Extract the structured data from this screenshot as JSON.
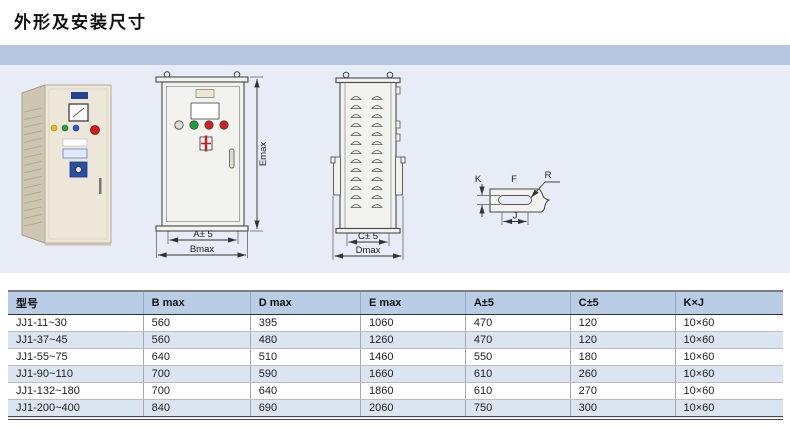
{
  "page": {
    "title": "外形及安装尺寸"
  },
  "drawings": {
    "front_view": {
      "height_label": "Emax",
      "inner_width_label": "A± 5",
      "outer_width_label": "Bmax"
    },
    "side_view": {
      "inner_depth_label": "C± 5",
      "outer_depth_label": "Dmax"
    },
    "slot_detail": {
      "plate_label": "F",
      "radius_label": "R",
      "slot_width_label": "K",
      "slot_length_label": "J"
    },
    "indicator_light_colors": [
      "#e0e0d6",
      "#1f9e40",
      "#d42020",
      "#d42020"
    ]
  },
  "table": {
    "headers": [
      "型号",
      "B max",
      "D max",
      "E max",
      "A±5",
      "C±5",
      "K×J"
    ],
    "rows": [
      [
        "JJ1-11~30",
        "560",
        "395",
        "1060",
        "470",
        "120",
        "10×60"
      ],
      [
        "JJ1-37~45",
        "560",
        "480",
        "1260",
        "470",
        "120",
        "10×60"
      ],
      [
        "JJ1-55~75",
        "640",
        "510",
        "1460",
        "550",
        "180",
        "10×60"
      ],
      [
        "JJ1-90~110",
        "700",
        "590",
        "1660",
        "610",
        "260",
        "10×60"
      ],
      [
        "JJ1-132~180",
        "700",
        "640",
        "1860",
        "610",
        "270",
        "10×60"
      ],
      [
        "JJ1-200~400",
        "840",
        "690",
        "2060",
        "750",
        "300",
        "10×60"
      ]
    ]
  },
  "colors": {
    "band_blue": "#b5c7e2",
    "drawing_background": "#e8ecf6",
    "table_header_blue": "#b9cde7",
    "table_alt_row": "#dbe5f1",
    "cabinet_beige": "#ece7d9",
    "emergency_red": "#cf1d1d"
  }
}
